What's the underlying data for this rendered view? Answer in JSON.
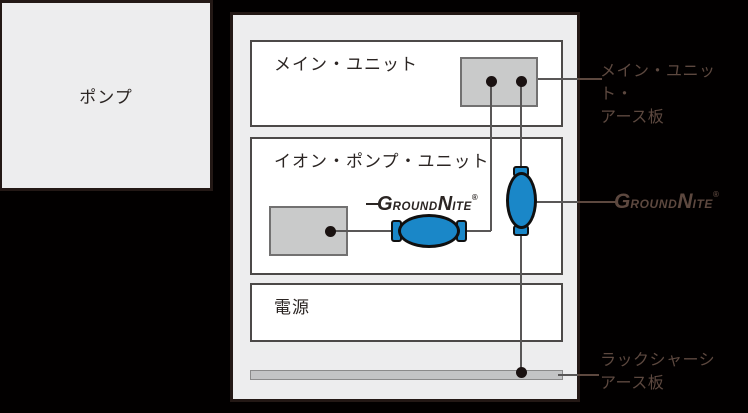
{
  "colors": {
    "background": "#020000",
    "panel_fill": "#ededee",
    "panel_border": "#231815",
    "unit_fill": "#ffffff",
    "unit_border": "#4c4948",
    "plate_fill": "#c9caca",
    "plate_border": "#727171",
    "bar_fill": "#c3c4c5",
    "wire": "#595757",
    "device_blue": "#1a87c8",
    "annotation_text": "#5d483f"
  },
  "pump": {
    "label": "ポンプ"
  },
  "rack": {
    "units": [
      {
        "label": "メイン・ユニット"
      },
      {
        "label": "イオン・ポンプ・ユニット"
      },
      {
        "label": "電源"
      }
    ]
  },
  "logo": {
    "g": "G",
    "round": "ROUND",
    "n": "N",
    "ite": "ITE",
    "reg": "®"
  },
  "annotations": {
    "main_earth": {
      "line1": "メイン・ユニット・",
      "line2": "アース板"
    },
    "chassis_earth": {
      "line1": "ラックシャーシ",
      "line2": "アース板"
    }
  }
}
